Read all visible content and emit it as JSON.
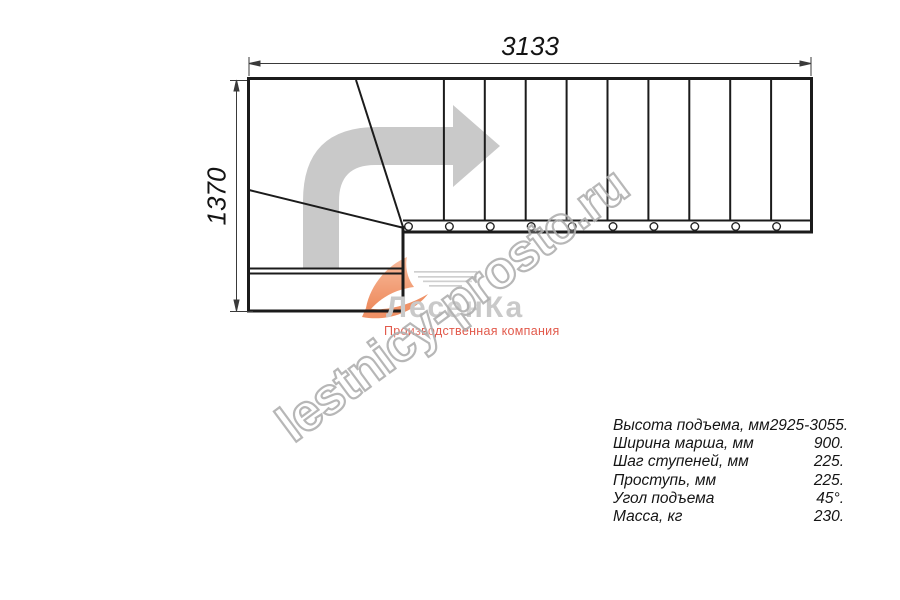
{
  "drawing": {
    "title": "L-shaped staircase plan view",
    "width_dimension": "3133",
    "height_dimension": "1370",
    "treads_in_straight_flight": 10,
    "arrow_color": "#c9c9c9",
    "line_color": "#1b1b1b"
  },
  "watermark": {
    "text": "lestnicy-prosto.ru",
    "color": "#b0b0b0"
  },
  "logo": {
    "name": "ЛесенКа",
    "tagline": "Производственная компания",
    "name_color": "#c9c9c9",
    "tagline_color": "#e25a4c",
    "swoosh_color": "#f2a07c"
  },
  "specs": {
    "rows": [
      {
        "label": "Высота подъема, мм",
        "value": "2925-3055."
      },
      {
        "label": "Ширина марша, мм",
        "value": "900."
      },
      {
        "label": "Шаг ступеней, мм",
        "value": "225."
      },
      {
        "label": "Проступь, мм",
        "value": "225."
      },
      {
        "label": "Угол подъема",
        "value": "45°."
      },
      {
        "label": "Масса, кг",
        "value": "230."
      }
    ]
  }
}
